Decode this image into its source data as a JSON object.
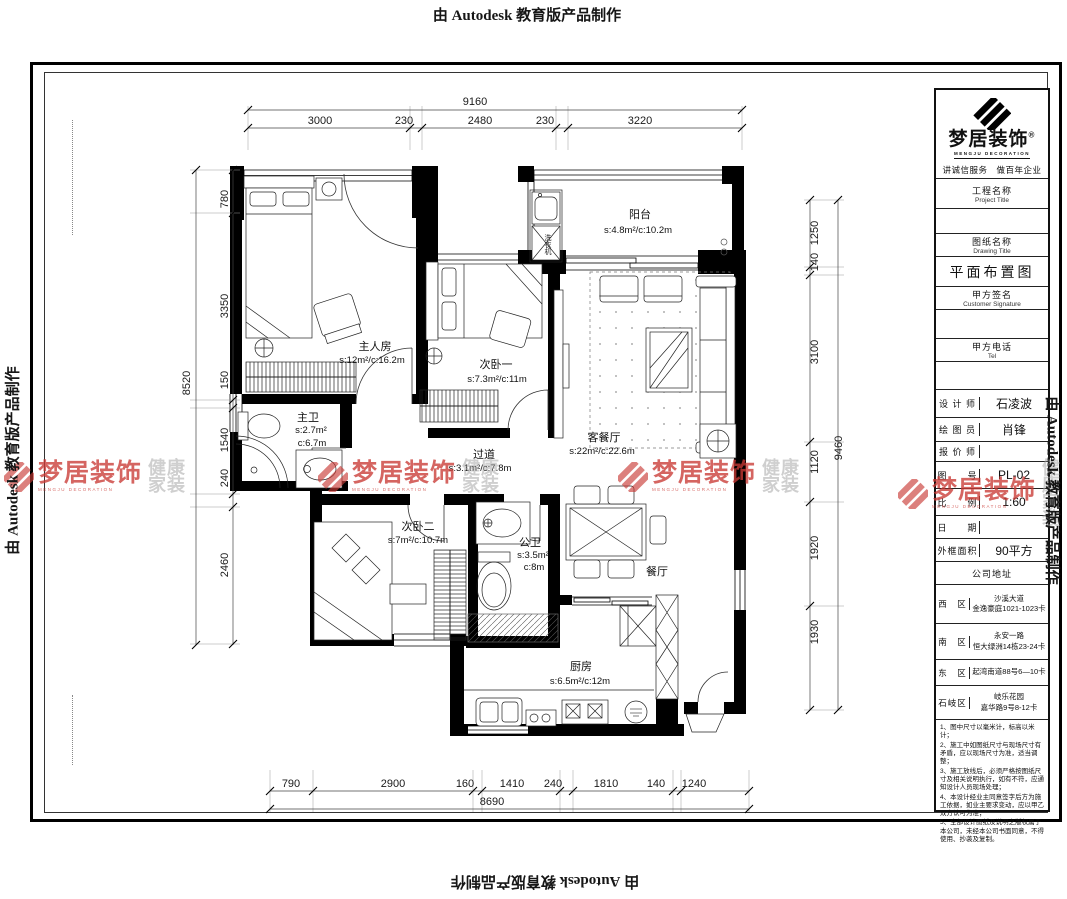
{
  "banner": {
    "text": "由 Autodesk 教育版产品制作"
  },
  "watermark": {
    "brand": "梦居装饰",
    "brand_en": "MENGJU DECORATION",
    "tag_line1": "健康",
    "tag_line2": "家装",
    "red": "#c93a34",
    "gray": "#a8a8a8"
  },
  "rooms": {
    "master": {
      "name": "主人房",
      "area": "s:12m²/c:16.2m"
    },
    "bedroom2": {
      "name": "次卧一",
      "area": "s:7.3m²/c:11m"
    },
    "bedroom3": {
      "name": "次卧二",
      "area": "s:7m²/c:10.7m"
    },
    "balcony": {
      "name": "阳台",
      "area": "s:4.8m²/c:10.2m"
    },
    "living": {
      "name": "客餐厅",
      "area": "s:22m²/c:22.6m"
    },
    "hallway": {
      "name": "过道",
      "area": "s:3.1m²/c:7.8m"
    },
    "master_bath": {
      "name": "主卫",
      "area_s": "s:2.7m²",
      "area_c": "c:6.7m"
    },
    "public_bath": {
      "name": "公卫",
      "area_s": "s:3.5m²",
      "area_c": "c:8m"
    },
    "dining": {
      "name": "餐厅"
    },
    "kitchen": {
      "name": "厨房",
      "area": "s:6.5m²/c:12m"
    },
    "washer_label": "洗衣机"
  },
  "dims": {
    "top": {
      "total": "9160",
      "segments": [
        "3000",
        "230",
        "2480",
        "230",
        "3220"
      ]
    },
    "left": {
      "total": "8520",
      "segments": [
        "780",
        "3350",
        "150",
        "1540",
        "240",
        "2460"
      ]
    },
    "right": {
      "total": "9460",
      "segments": [
        "1250",
        "140",
        "3100",
        "1120",
        "1920",
        "1930"
      ]
    },
    "bottom": {
      "total": "8690",
      "segments": [
        "790",
        "2900",
        "160",
        "1410",
        "240",
        "1810",
        "140",
        "1240"
      ]
    }
  },
  "titleblock": {
    "brand": "梦居装饰",
    "brand_reg": "®",
    "brand_en": "MENGJU DECORATION",
    "slogan": "讲诚信服务　做百年企业",
    "project_label": "工程名称",
    "project_label_en": "Project Title",
    "drawing_label": "图纸名称",
    "drawing_label_en": "Drawing Title",
    "drawing_name": "平面布置图",
    "sign_label": "甲方签名",
    "sign_label_en": "Customer Signature",
    "tel_label": "甲方电话",
    "tel_label_en": "Tel",
    "fields": [
      {
        "label": "设 计 师",
        "value": "石凌波"
      },
      {
        "label": "绘 图 员",
        "value": "肖锋"
      },
      {
        "label": "报 价 师",
        "value": ""
      },
      {
        "label": "图　　号",
        "value": "PL-02"
      },
      {
        "label": "比　　例",
        "value": "1:60"
      },
      {
        "label": "日　　期",
        "value": ""
      },
      {
        "label": "外框面积",
        "value": "90平方"
      }
    ],
    "company_label": "公司地址",
    "addresses": [
      {
        "label": "西　区",
        "value": "沙溪大道\n金逸豪庭1021-1023卡"
      },
      {
        "label": "南　区",
        "value": "永安一路\n恒大绿洲14栋23-24卡"
      },
      {
        "label": "东　区",
        "value": "起湾南道88号6—10卡"
      },
      {
        "label": "石岐区",
        "value": "岐乐花园\n嘉华路9号8-12卡"
      }
    ],
    "notes": [
      "1、图中尺寸以毫米计，标高以米计；",
      "2、施工中如图纸尺寸与现场尺寸有矛盾，应以现场尺寸为准，适当调整；",
      "3、施工放线后，必须严格按图纸尺寸及相关说明执行，如有不符，应通知设计人员现场处理；",
      "4、本设计经业主同意签字后方为施工依据，如业主要求变动，应以甲乙双方认可为准；",
      "5、全部设计图纸及说明之版权属于本公司，未经本公司书面同意，不得使用、抄袭及复制。"
    ]
  }
}
